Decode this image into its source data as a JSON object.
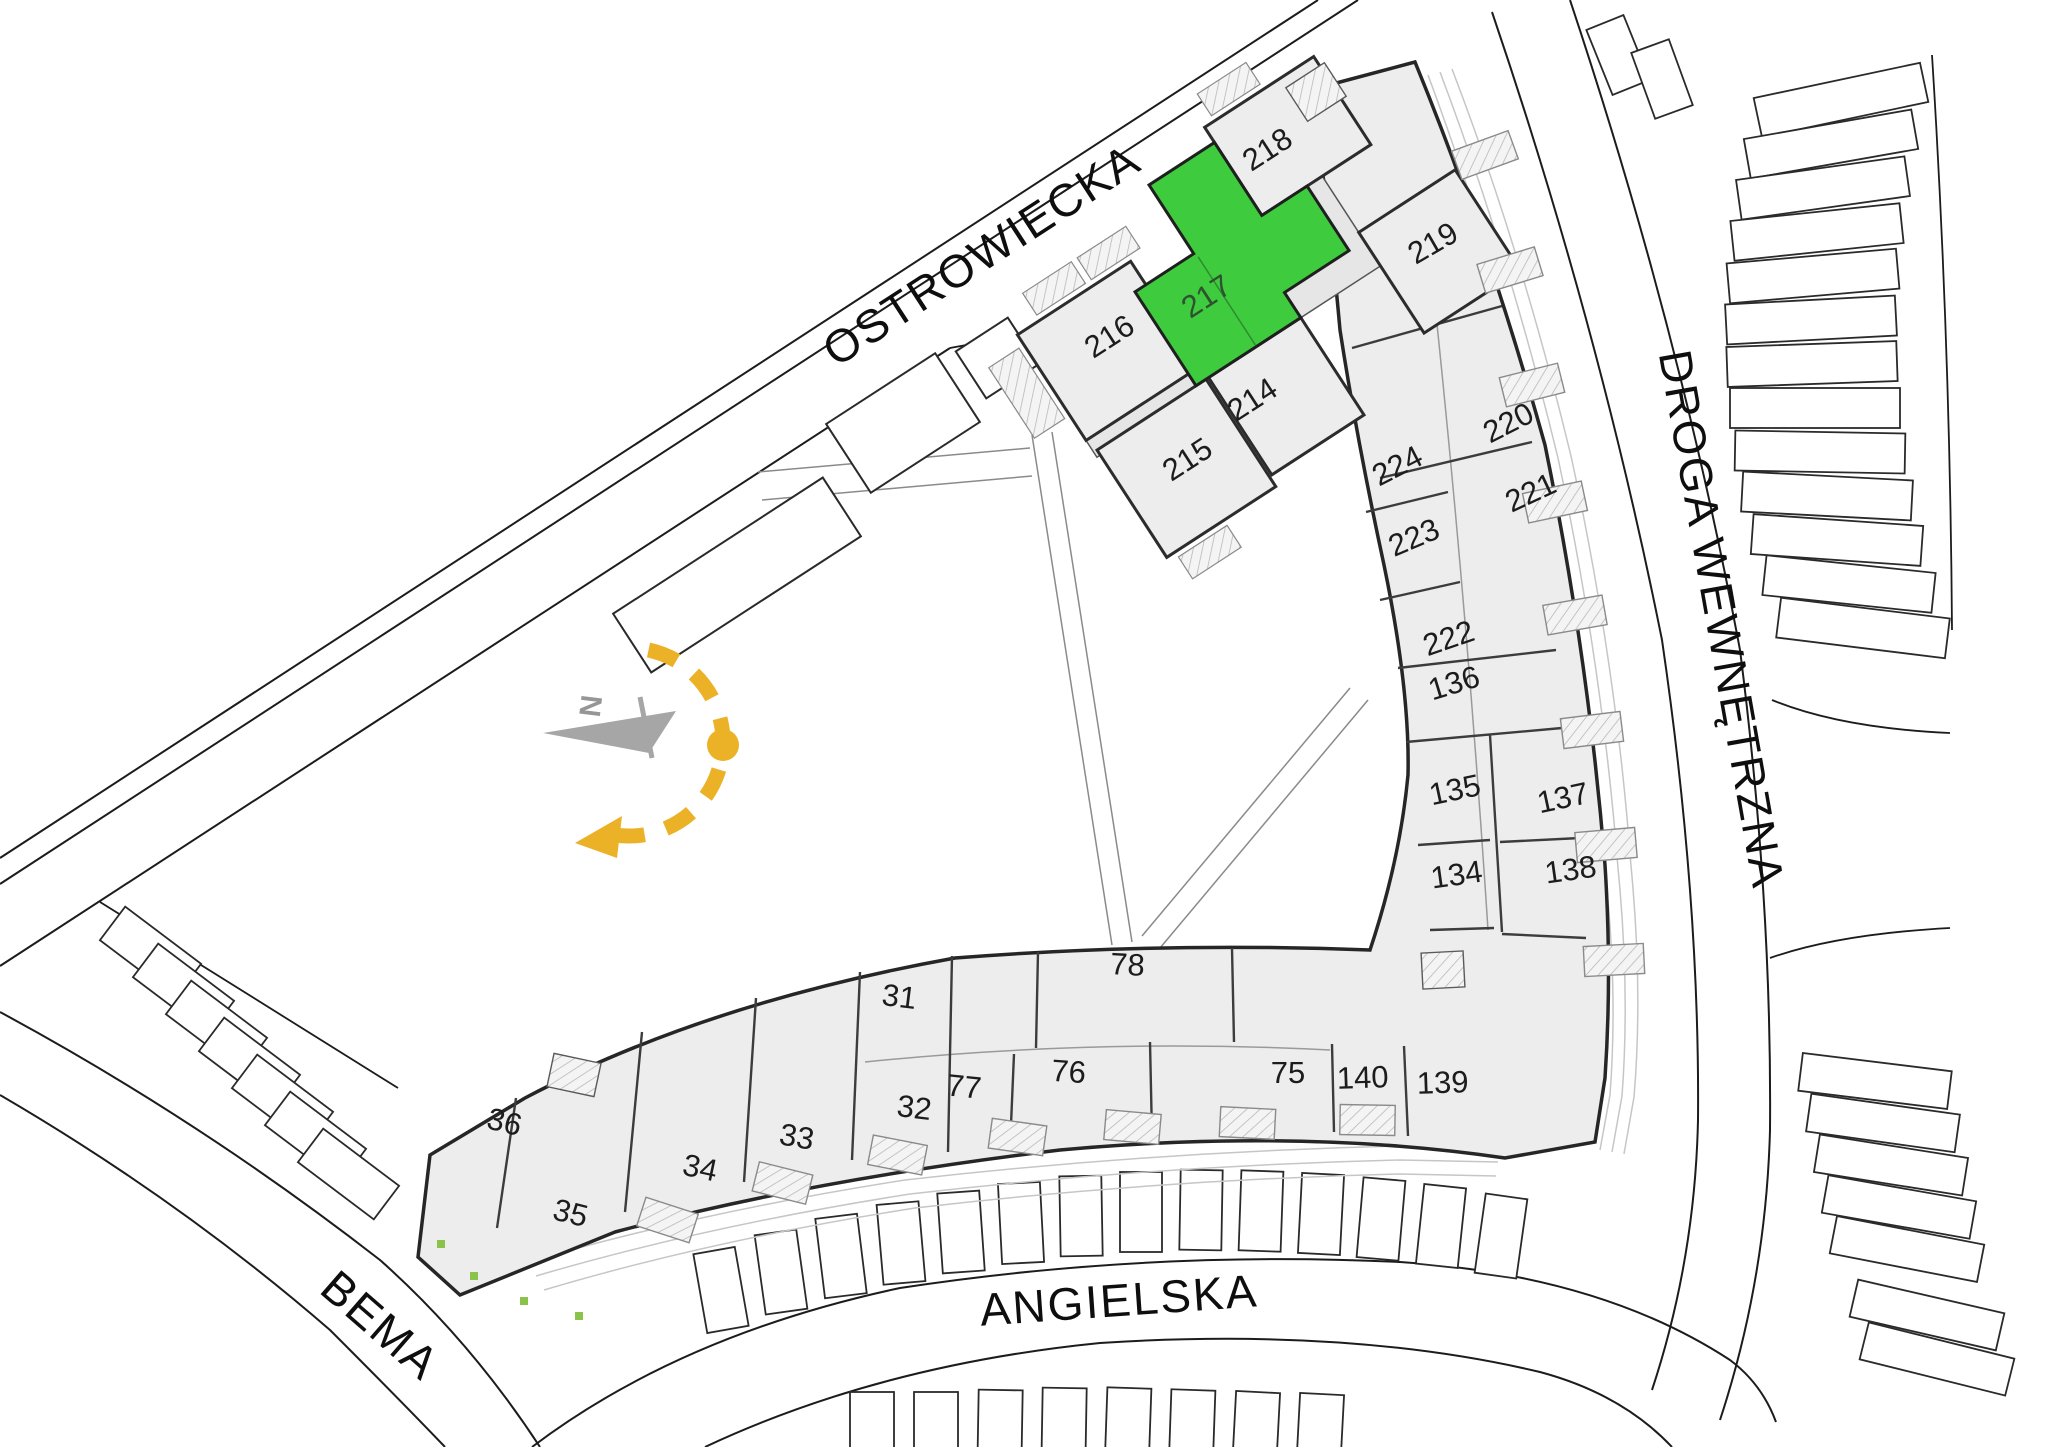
{
  "plan": {
    "highlighted_unit": "217",
    "colors": {
      "highlight": "#3ecb3e",
      "sun": "#ecb227",
      "compass_arrow": "#a6a6a6",
      "building_fill": "#ededed"
    },
    "compass": {
      "north_label": "N"
    },
    "streets": [
      {
        "id": "ostrowiecka",
        "name": "OSTROWIECKA",
        "x": 990,
        "y": 268,
        "rotation": -33
      },
      {
        "id": "droga-wewnetrzna",
        "name": "DROGA WEWNĘTRZNA",
        "x": 1706,
        "y": 622,
        "rotation": 80
      },
      {
        "id": "angielska",
        "name": "ANGIELSKA",
        "x": 1120,
        "y": 1316,
        "rotation": -4
      },
      {
        "id": "bema",
        "name": "BEMA",
        "x": 370,
        "y": 1337,
        "rotation": 41
      }
    ],
    "units": [
      {
        "number": "218",
        "x": 1273,
        "y": 158,
        "rotation": -33,
        "highlighted": false
      },
      {
        "number": "219",
        "x": 1438,
        "y": 252,
        "rotation": -30,
        "highlighted": false
      },
      {
        "number": "217",
        "x": 1212,
        "y": 305,
        "rotation": -33,
        "highlighted": true
      },
      {
        "number": "216",
        "x": 1115,
        "y": 345,
        "rotation": -33,
        "highlighted": false
      },
      {
        "number": "214",
        "x": 1258,
        "y": 408,
        "rotation": -33,
        "highlighted": false
      },
      {
        "number": "215",
        "x": 1193,
        "y": 468,
        "rotation": -33,
        "highlighted": false
      },
      {
        "number": "220",
        "x": 1513,
        "y": 432,
        "rotation": -27,
        "highlighted": false
      },
      {
        "number": "224",
        "x": 1402,
        "y": 475,
        "rotation": -27,
        "highlighted": false
      },
      {
        "number": "221",
        "x": 1535,
        "y": 502,
        "rotation": -25,
        "highlighted": false
      },
      {
        "number": "223",
        "x": 1418,
        "y": 547,
        "rotation": -23,
        "highlighted": false
      },
      {
        "number": "222",
        "x": 1452,
        "y": 648,
        "rotation": -19,
        "highlighted": false
      },
      {
        "number": "136",
        "x": 1457,
        "y": 693,
        "rotation": -17,
        "highlighted": false
      },
      {
        "number": "135",
        "x": 1457,
        "y": 800,
        "rotation": -12,
        "highlighted": false
      },
      {
        "number": "137",
        "x": 1565,
        "y": 808,
        "rotation": -12,
        "highlighted": false
      },
      {
        "number": "134",
        "x": 1458,
        "y": 885,
        "rotation": -8,
        "highlighted": false
      },
      {
        "number": "138",
        "x": 1572,
        "y": 880,
        "rotation": -8,
        "highlighted": false
      },
      {
        "number": "139",
        "x": 1443,
        "y": 1093,
        "rotation": -2,
        "highlighted": false
      },
      {
        "number": "140",
        "x": 1363,
        "y": 1088,
        "rotation": -2,
        "highlighted": false
      },
      {
        "number": "75",
        "x": 1288,
        "y": 1083,
        "rotation": 0,
        "highlighted": false
      },
      {
        "number": "76",
        "x": 1068,
        "y": 1082,
        "rotation": 4,
        "highlighted": false
      },
      {
        "number": "77",
        "x": 963,
        "y": 1097,
        "rotation": 6,
        "highlighted": false
      },
      {
        "number": "78",
        "x": 1127,
        "y": 975,
        "rotation": 3,
        "highlighted": false
      },
      {
        "number": "31",
        "x": 898,
        "y": 1007,
        "rotation": 7,
        "highlighted": false
      },
      {
        "number": "32",
        "x": 913,
        "y": 1118,
        "rotation": 7,
        "highlighted": false
      },
      {
        "number": "33",
        "x": 795,
        "y": 1147,
        "rotation": 10,
        "highlighted": false
      },
      {
        "number": "34",
        "x": 698,
        "y": 1178,
        "rotation": 12,
        "highlighted": false
      },
      {
        "number": "35",
        "x": 568,
        "y": 1223,
        "rotation": 14,
        "highlighted": false
      },
      {
        "number": "36",
        "x": 502,
        "y": 1132,
        "rotation": 14,
        "highlighted": false
      }
    ]
  }
}
